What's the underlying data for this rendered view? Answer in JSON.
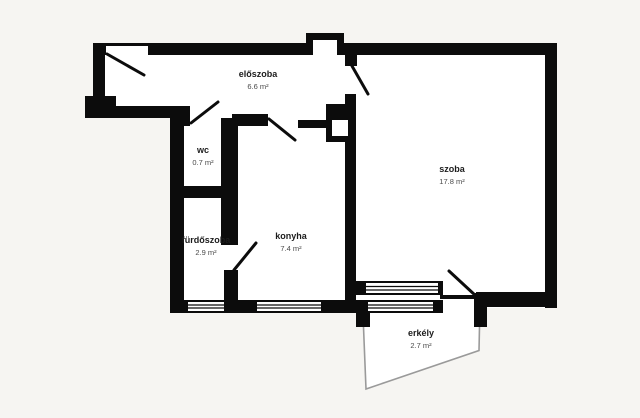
{
  "title": "apartment-floor-plan",
  "colors": {
    "background": "#f6f5f2",
    "wall": "#0c0c0c",
    "floor": "#ffffff",
    "balcony_outline": "#9a9a9a",
    "room_name_text": "#1c1c1c",
    "room_area_text": "#4a4a4a"
  },
  "rooms": {
    "eloszoba": {
      "name": "előszoba",
      "area": "6.6 m²"
    },
    "wc": {
      "name": "wc",
      "area": "0.7 m²"
    },
    "furdoszoba": {
      "name": "fürdőszoba",
      "area": "2.9 m²"
    },
    "konyha": {
      "name": "konyha",
      "area": "7.4 m²"
    },
    "szoba": {
      "name": "szoba",
      "area": "17.8 m²"
    },
    "erkely": {
      "name": "erkély",
      "area": "2.7 m²"
    }
  }
}
